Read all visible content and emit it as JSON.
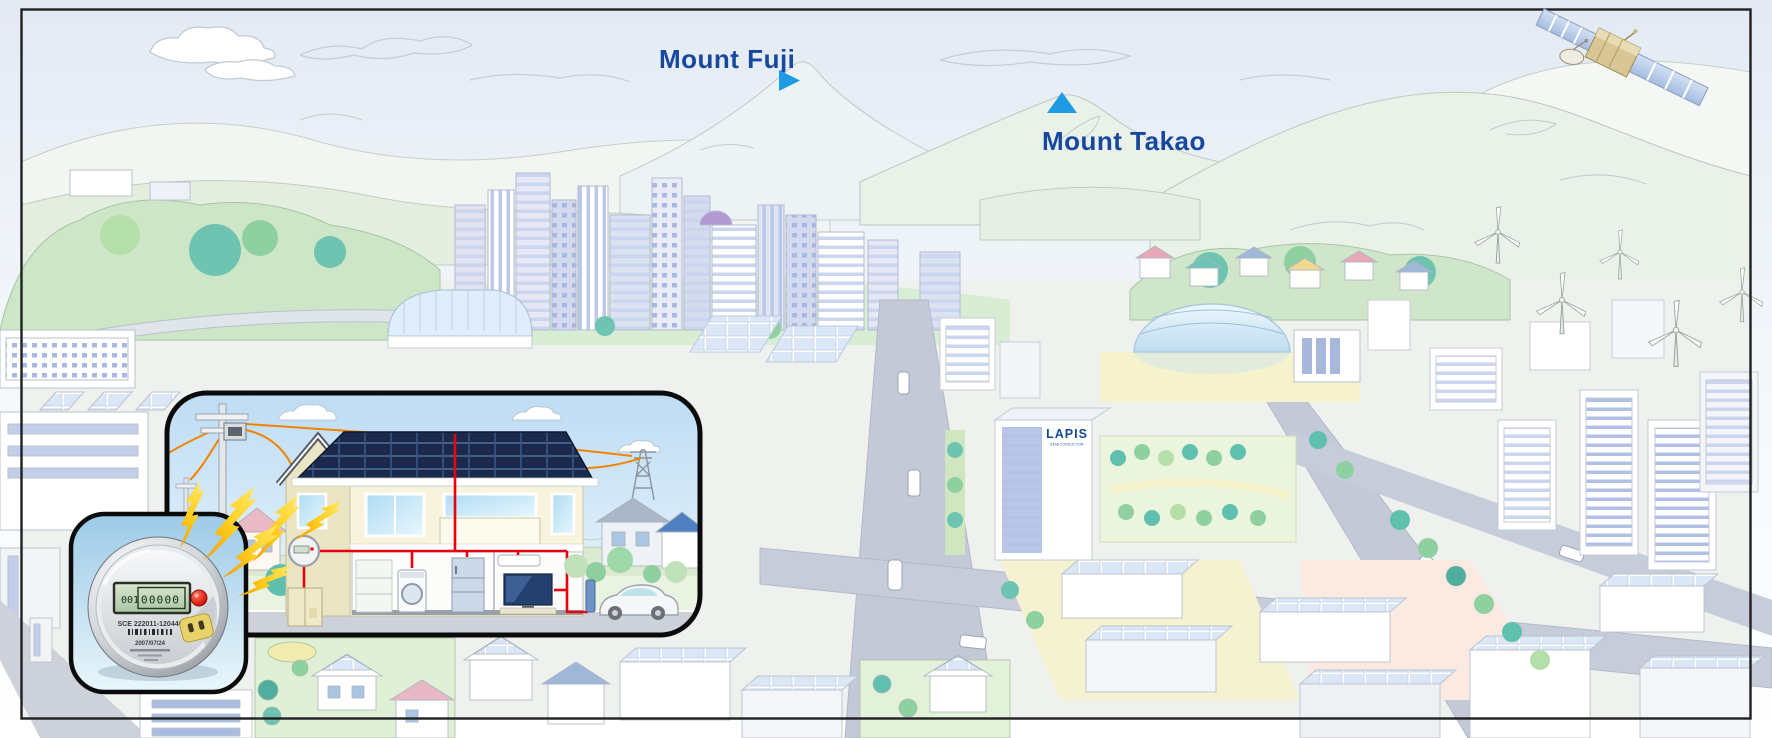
{
  "labels": {
    "mount_fuji": "Mount Fuji",
    "mount_takao": "Mount Takao"
  },
  "lapis_building": {
    "logo": "LAPIS",
    "logo_sub": "SEMICONDUCTOR"
  },
  "smart_meter": {
    "lcd_left": "001",
    "lcd_right": "00000",
    "serial": "SCE 222011-120446",
    "date": "2007/07/24"
  },
  "colors": {
    "label_blue": "#17489e",
    "marker_blue": "#1e9be2",
    "logo_blue": "#16489a",
    "wire_red": "#e60012",
    "powerline_orange": "#f08300",
    "lightning_yellow": "#ffd633"
  }
}
